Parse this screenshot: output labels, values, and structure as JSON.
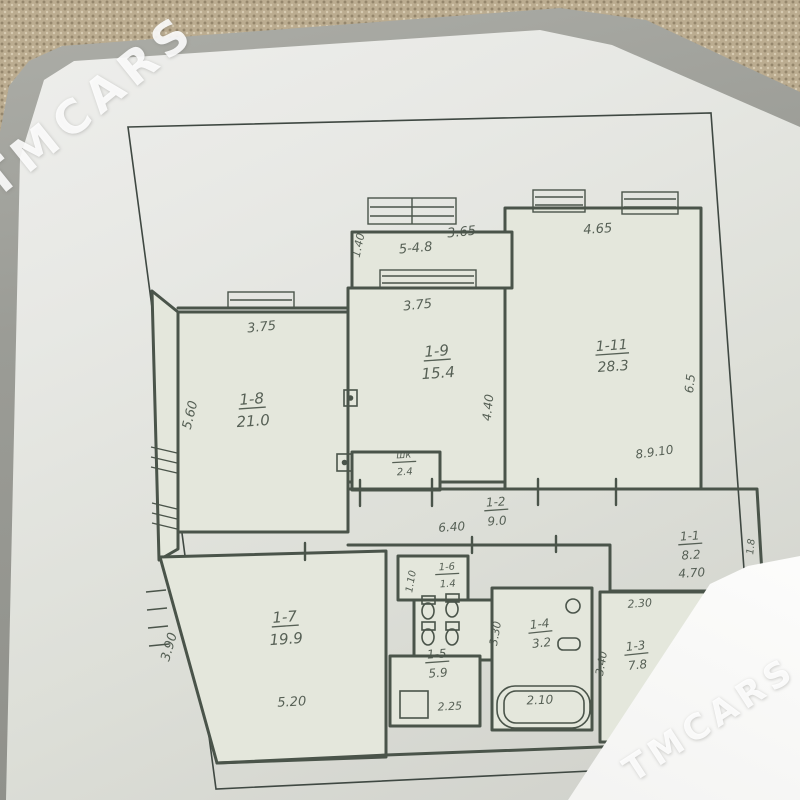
{
  "watermark": {
    "brand": "TMCARS"
  },
  "colors": {
    "ink": "#4a544a",
    "border_ink": "#3f4842",
    "room_fill": "#e4e7dc",
    "carpet": "#bbac90",
    "card": "#fdfdfc"
  },
  "floorplan": {
    "type": "hand-drawn apartment plan (BTI style), photographed on album page",
    "rooms": [
      {
        "label": "1-8",
        "area": "21.0",
        "x": 252,
        "y": 404,
        "fs": 15,
        "rot": -4
      },
      {
        "label": "1-9",
        "area": "15.4",
        "x": 437,
        "y": 356,
        "fs": 15,
        "rot": -4
      },
      {
        "label": "1-11",
        "area": "28.3",
        "x": 612,
        "y": 350,
        "fs": 14,
        "rot": -4
      },
      {
        "label": "1-7",
        "area": "19.9",
        "x": 285,
        "y": 622,
        "fs": 15,
        "rot": -4
      },
      {
        "label": "1-2",
        "area": "9.0",
        "x": 496,
        "y": 506,
        "fs": 12,
        "rot": -4
      },
      {
        "label": "1-1",
        "area": "8.2",
        "x": 690,
        "y": 540,
        "fs": 12,
        "rot": -4
      },
      {
        "label": "шк",
        "area": "2.4",
        "x": 404,
        "y": 458,
        "fs": 10,
        "rot": -3
      },
      {
        "label": "1-6",
        "area": "1.4",
        "x": 447,
        "y": 570,
        "fs": 10,
        "rot": -3
      },
      {
        "label": "1-5",
        "area": "5.9",
        "x": 437,
        "y": 658,
        "fs": 12,
        "rot": -4
      },
      {
        "label": "1-4",
        "area": "3.2",
        "x": 540,
        "y": 628,
        "fs": 12,
        "rot": -6
      },
      {
        "label": "1-3",
        "area": "7.8",
        "x": 636,
        "y": 650,
        "fs": 12,
        "rot": -6
      },
      {
        "label": "5-4.8",
        "area": "",
        "x": 416,
        "y": 252,
        "fs": 13,
        "rot": -5
      }
    ],
    "dimensions": [
      {
        "text": "3.65",
        "x": 462,
        "y": 236,
        "rot": -6,
        "fs": 13
      },
      {
        "text": "1.40",
        "x": 362,
        "y": 246,
        "rot": -78,
        "fs": 11
      },
      {
        "text": "4.65",
        "x": 598,
        "y": 233,
        "rot": -4,
        "fs": 13
      },
      {
        "text": "3.75",
        "x": 262,
        "y": 331,
        "rot": -6,
        "fs": 13
      },
      {
        "text": "3.75",
        "x": 418,
        "y": 309,
        "rot": -6,
        "fs": 13
      },
      {
        "text": "5.60",
        "x": 194,
        "y": 416,
        "rot": -76,
        "fs": 13
      },
      {
        "text": "4.40",
        "x": 492,
        "y": 408,
        "rot": -84,
        "fs": 12
      },
      {
        "text": "6.5",
        "x": 694,
        "y": 384,
        "rot": -84,
        "fs": 12
      },
      {
        "text": "8.9.10",
        "x": 655,
        "y": 456,
        "rot": -8,
        "fs": 12
      },
      {
        "text": "6.40",
        "x": 452,
        "y": 531,
        "rot": -4,
        "fs": 12
      },
      {
        "text": "4.70",
        "x": 692,
        "y": 577,
        "rot": -4,
        "fs": 12
      },
      {
        "text": "1.8",
        "x": 754,
        "y": 547,
        "rot": -84,
        "fs": 10
      },
      {
        "text": "2.30",
        "x": 640,
        "y": 607,
        "rot": -4,
        "fs": 11
      },
      {
        "text": "3.40",
        "x": 605,
        "y": 664,
        "rot": -80,
        "fs": 11
      },
      {
        "text": "3.30",
        "x": 499,
        "y": 634,
        "rot": -80,
        "fs": 11
      },
      {
        "text": "1.10",
        "x": 414,
        "y": 582,
        "rot": -80,
        "fs": 10
      },
      {
        "text": "3.90",
        "x": 173,
        "y": 648,
        "rot": -74,
        "fs": 13
      },
      {
        "text": "5.20",
        "x": 292,
        "y": 706,
        "rot": -3,
        "fs": 13
      },
      {
        "text": "2.25",
        "x": 450,
        "y": 710,
        "rot": -3,
        "fs": 11
      },
      {
        "text": "2.10",
        "x": 540,
        "y": 704,
        "rot": -2,
        "fs": 12
      }
    ]
  }
}
